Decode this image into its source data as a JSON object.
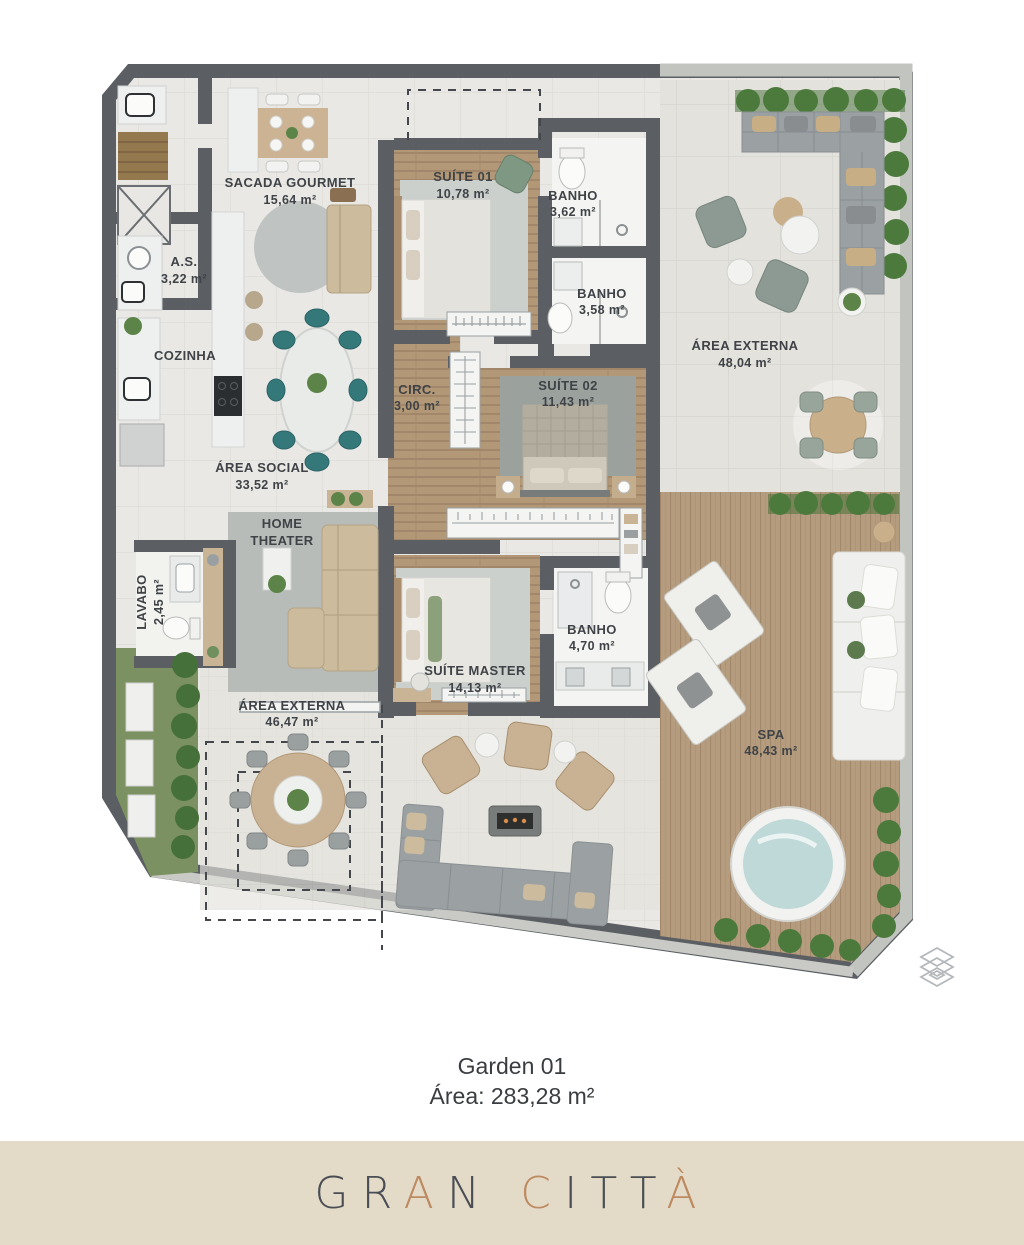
{
  "plan": {
    "rooms": {
      "sacada": {
        "name": "SACADA GOURMET",
        "area": "15,64 m²"
      },
      "as": {
        "name": "A.S.",
        "area": "3,22 m²"
      },
      "cozinha": {
        "name": "COZINHA"
      },
      "social": {
        "name": "ÁREA SOCIAL",
        "area": "33,52 m²"
      },
      "home_theater": {
        "line1": "HOME",
        "line2": "THEATER"
      },
      "lavabo": {
        "name": "LAVABO",
        "area": "2,45 m²"
      },
      "suite01": {
        "name": "SUÍTE 01",
        "area": "10,78 m²"
      },
      "banho1": {
        "name": "BANHO",
        "area": "3,62 m²"
      },
      "banho2": {
        "name": "BANHO",
        "area": "3,58 m²"
      },
      "circ": {
        "name": "CIRC.",
        "area": "3,00 m²"
      },
      "suite02": {
        "name": "SUÍTE 02",
        "area": "11,43 m²"
      },
      "externa_top": {
        "name": "ÁREA EXTERNA",
        "area": "48,04 m²"
      },
      "suite_master": {
        "name": "SUÍTE MASTER",
        "area": "14,13 m²"
      },
      "banho_master": {
        "name": "BANHO",
        "area": "4,70 m²"
      },
      "externa_bottom": {
        "name": "ÁREA EXTERNA",
        "area": "46,47 m²"
      },
      "spa": {
        "name": "SPA",
        "area": "48,43 m²"
      }
    }
  },
  "caption": {
    "title": "Garden 01",
    "area": "Área: 283,28 m²"
  },
  "brand": {
    "text": "GRAN CITTÀ",
    "dark": "#4a4e54",
    "copper": "#bd8a61",
    "letter_colors": [
      "#4a4e54",
      "#4a4e54",
      "#bd8a61",
      "#4a4e54",
      "",
      "#bd8a61",
      "#4a4e54",
      "#4a4e54",
      "#4a4e54",
      "#bd8a61"
    ]
  },
  "colors": {
    "wall": "#5b5f63",
    "concrete_wall": "#c2c4c0",
    "tile_floor": "#e9e8e4",
    "wood_floor": "#b29877",
    "deck": "#b59c7e",
    "hedge_green": "#4c7a3c",
    "grass": "#7c9162",
    "teal_chair": "#35787a",
    "beige_furniture": "#cdbb9e",
    "gray_sofa": "#9ba1a3",
    "spa_water": "#bfd9d8",
    "band_beige": "#e3dbc8",
    "label_text": "#3f4347"
  },
  "icons": {
    "corner_icon": "layers-icon"
  }
}
